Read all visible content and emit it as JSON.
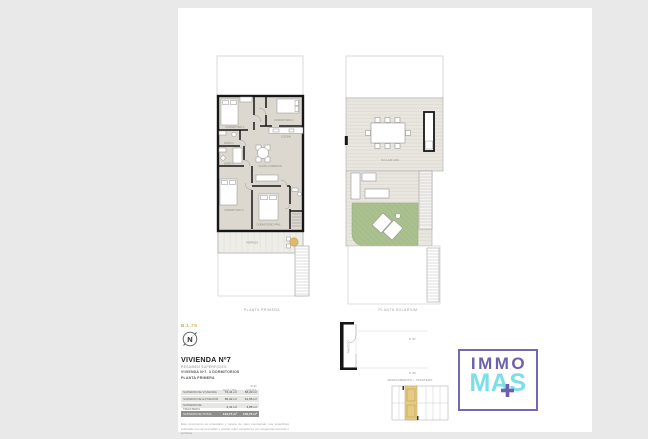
{
  "colors": {
    "page_bg": "#e9e9e9",
    "sheet_bg": "#ffffff",
    "wall": "#161616",
    "floor_fill": "#dcd7cf",
    "deck_fill": "#e9e6e0",
    "grass_green": "#aac08e",
    "gold_highlight": "#e6cb83",
    "ref_gold_text": "#c9ae55",
    "logo_purple": "#6d61ab",
    "logo_cyan": "#7adfe8",
    "table_row_bg": "#e6e6e4",
    "table_total_bg": "#8e8e8c"
  },
  "plan_first": {
    "caption": "PLANTA PRIMERA",
    "rooms": {
      "bedroom1": "DORMITORIO 1",
      "bedroom2": "DORMITORIO 2",
      "bedroom3": "DORMITORIO 3",
      "bedroom_main": "DORMITORIO PPAL.",
      "bath1": "BAÑO 1",
      "bath2": "BAÑO 2",
      "kitchen": "COCINA",
      "living": "SALÓN-COMEDOR",
      "terrace": "TERRAZA"
    }
  },
  "plan_solarium": {
    "caption": "PLANTA SOLARIUM",
    "label": "SOLARIUM"
  },
  "section_detail": {
    "trastero_label": "TRASTERO",
    "level_upper": "P. 07",
    "level_lower": "P. 06",
    "caption": "APARCAMIENTO + TRASTERO"
  },
  "title_block": {
    "ref": "B.1.7S",
    "compass": "N",
    "title": "VIVIENDA Nº7",
    "line1": "RESUMEN SUPERFICIES",
    "line2": "VIVIENDA Nº7. 3 DORMITORIOS",
    "line3": "PLANTA PRIMERA",
    "table": {
      "col_util": "SUP. ÚTIL",
      "col_const": "SUP. CONST.",
      "rows": [
        {
          "label": "SUPERFICIE VIVIENDA",
          "util": "72,41 m²",
          "construida": "83,20 m²"
        },
        {
          "label": "SUPERFICIE EXTERIOR",
          "util": "60,02 m²",
          "construida": "61,65 m²"
        },
        {
          "label": "SUPERFICIE TRASTERO",
          "util": "2,31 m²",
          "construida": "3,85 m²"
        }
      ],
      "total": {
        "label": "SUPERFICIE TOTAL",
        "util": "134,74 m²",
        "construida": "148,70 m²"
      }
    },
    "disclaimer1": "Este documento es orientativo y carece de valor contractual. Las superficies indicadas son aproximadas y podrán sufrir variaciones por exigencias técnicas o jurídicas.",
    "disclaimer2": "Mobiliario y vegetación meramente decorativos. Información conforme al R.D. 515/1989 en nuestras oficinas."
  },
  "logo": {
    "word1": "IMMO",
    "word2": "MAS"
  }
}
